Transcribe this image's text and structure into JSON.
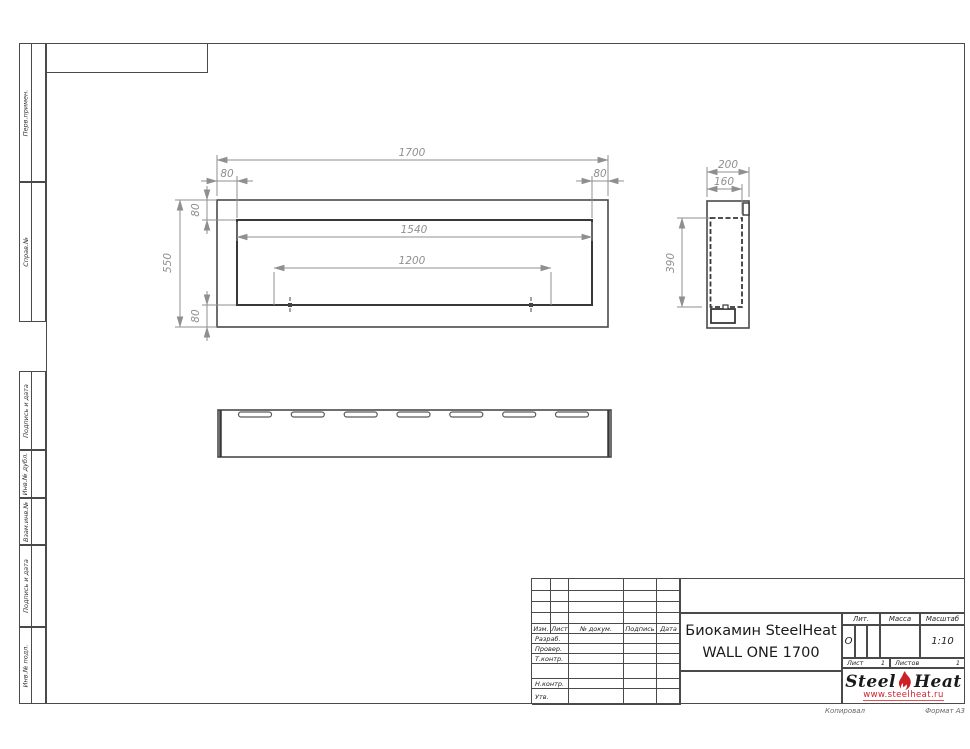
{
  "side_strip": {
    "items": [
      {
        "label": "Перв.примен."
      },
      {
        "label": "Справ.№"
      },
      {
        "label": "Подпись и дата"
      },
      {
        "label": "Инв.№ дубл."
      },
      {
        "label": "Взам.инв.№"
      },
      {
        "label": "Подпись и дата"
      },
      {
        "label": "Инв.№ подл."
      }
    ]
  },
  "views": {
    "front": {
      "dim_width": "1700",
      "dim_frame_left": "80",
      "dim_frame_right": "80",
      "dim_frame_top": "80",
      "dim_frame_bottom": "80",
      "dim_inner_width": "1540",
      "dim_mount_width": "1200",
      "dim_height": "550"
    },
    "side": {
      "dim_depth": "200",
      "dim_inner_depth": "160",
      "dim_inner_height": "390"
    }
  },
  "title_block": {
    "change_table": {
      "izm": "Изм.",
      "list": "Лист",
      "doc": "№ докум.",
      "podpis": "Подпись",
      "data": "Дата"
    },
    "roles": {
      "razrab": "Разраб.",
      "prover": "Провер.",
      "tkontr": "Т.контр.",
      "nkontr": "Н.контр.",
      "utv": "Утв."
    },
    "doc_title_line1": "Биокамин SteelHeat",
    "doc_title_line2": "WALL ONE 1700",
    "lit": {
      "label": "Лит.",
      "value": "О"
    },
    "massa": {
      "label": "Масса",
      "value": ""
    },
    "scale": {
      "label": "Масштаб",
      "value": "1:10"
    },
    "sheet": {
      "label": "Лист",
      "value": "1"
    },
    "sheets": {
      "label": "Листов",
      "value": "1"
    }
  },
  "logo": {
    "steel": "Steel",
    "heat": "Heat",
    "url": "www.steelheat.ru"
  },
  "footer": {
    "copied": "Копировал",
    "format": "Формат А3"
  },
  "colors": {
    "line": "#4a4a4a",
    "dim": "#8f8f8f",
    "accent_red": "#cc2127"
  }
}
